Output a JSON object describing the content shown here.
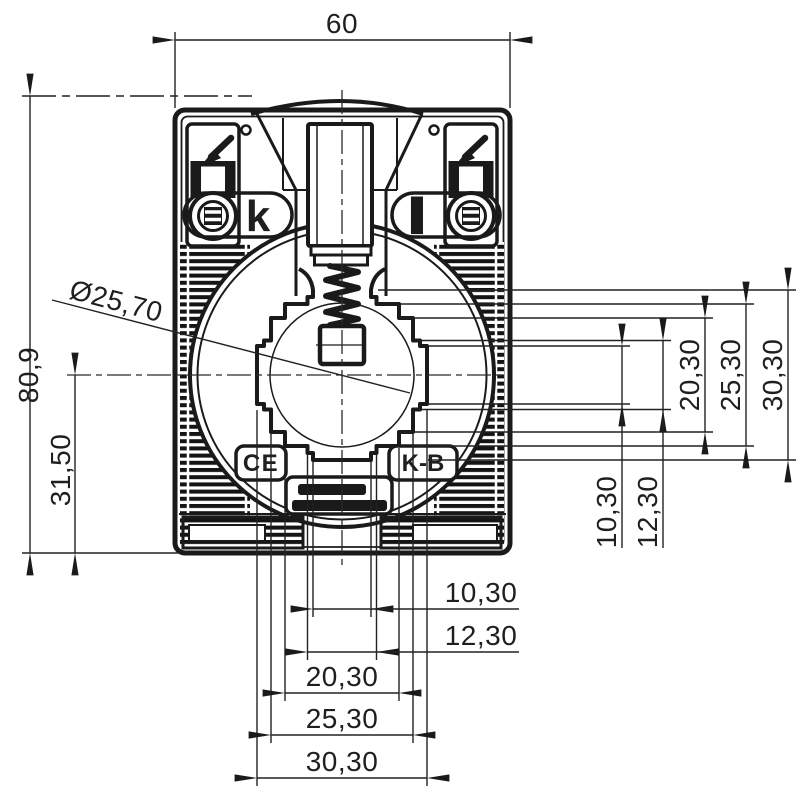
{
  "drawing": {
    "top_width": "60",
    "overall_height": "80,9",
    "center_height": "31,50",
    "aperture_diameter_label": "Ø25,70",
    "chain": {
      "d10": "10,30",
      "d12": "12,30",
      "d20": "20,30",
      "d25": "25,30",
      "d30": "30,30"
    },
    "terminal_left": "k",
    "terminal_right": "l",
    "ce_mark": "CE",
    "maker_logo": "K-B"
  }
}
